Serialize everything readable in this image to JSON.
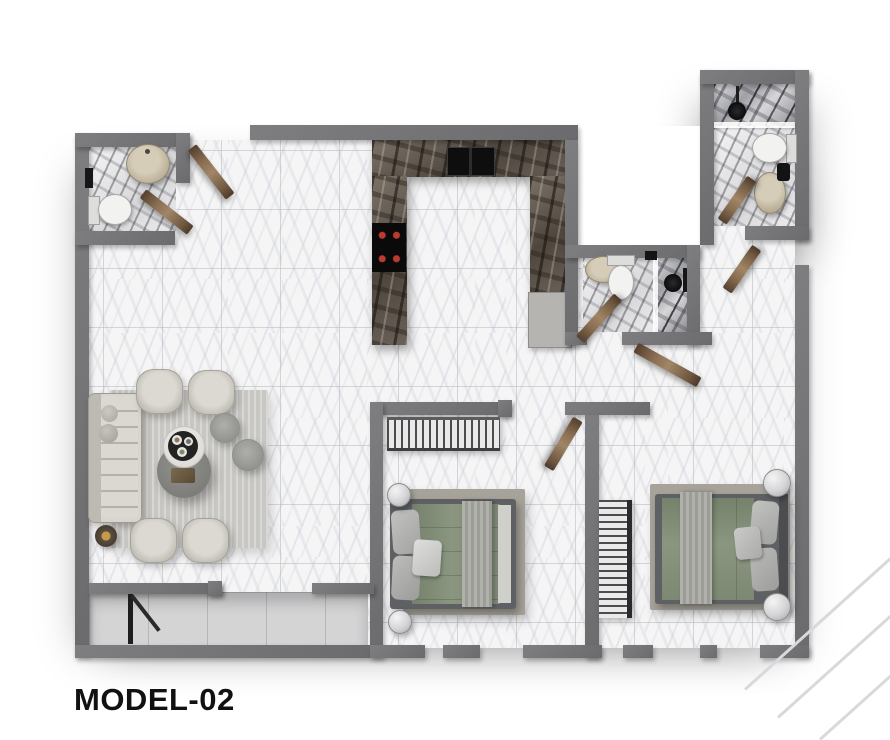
{
  "title": "MODEL-02",
  "plan": {
    "type": "apartment-floor-plan",
    "rooms": [
      {
        "name": "living-dining-room",
        "furniture": [
          "corner-sofa",
          "armchair",
          "armchair",
          "armchair",
          "armchair",
          "round-coffee-table",
          "round-serving-table",
          "serving-tray",
          "pouf",
          "pouf",
          "gold-side-table",
          "area-rug"
        ]
      },
      {
        "name": "kitchen",
        "furniture": [
          "u-shaped-marble-counter",
          "double-basin-sink",
          "cooktop-4-burners",
          "appliance-cabinet"
        ]
      },
      {
        "name": "bathroom-top-left",
        "furniture": [
          "round-basin",
          "toilet",
          "wall-fixture"
        ]
      },
      {
        "name": "bathroom-top-right",
        "furniture": [
          "shower-head",
          "glass-screen",
          "toilet",
          "oval-basin",
          "towel-rail"
        ]
      },
      {
        "name": "bathroom-middle",
        "furniture": [
          "oval-basin",
          "toilet",
          "shower-head",
          "glass-screen"
        ]
      },
      {
        "name": "bedroom-1",
        "furniture": [
          "open-wardrobe",
          "double-bed",
          "round-nightstand",
          "round-nightstand",
          "rug"
        ]
      },
      {
        "name": "bedroom-2",
        "furniture": [
          "shelf-wardrobe",
          "double-bed",
          "round-nightstand",
          "round-nightstand",
          "rug"
        ]
      },
      {
        "name": "balcony",
        "furniture": [
          "sliding-glass-door"
        ]
      }
    ],
    "door_count": 8
  },
  "colors": {
    "wall": "#747476",
    "floor_tile": "#f5f5f6",
    "tile_line": "#b6b9be",
    "bathroom_marble": "#9a9ba0",
    "counter_marble": "#5d564d",
    "wood_door": "#866b50",
    "sofa": "#d2cfc8",
    "living_rug": "#c8c7c3",
    "bedroom_rug": "#a6a299",
    "bed_duvet_sage": "#87927c",
    "bed_frame": "#5c5e60",
    "throw_blanket": "#a9a9a4",
    "basin_beige": "#c2b8a2",
    "fixture_black": "#141414",
    "cooktop_burner": "#b23a32",
    "title_text": "#111111",
    "watermark": "#d8d9dc"
  }
}
